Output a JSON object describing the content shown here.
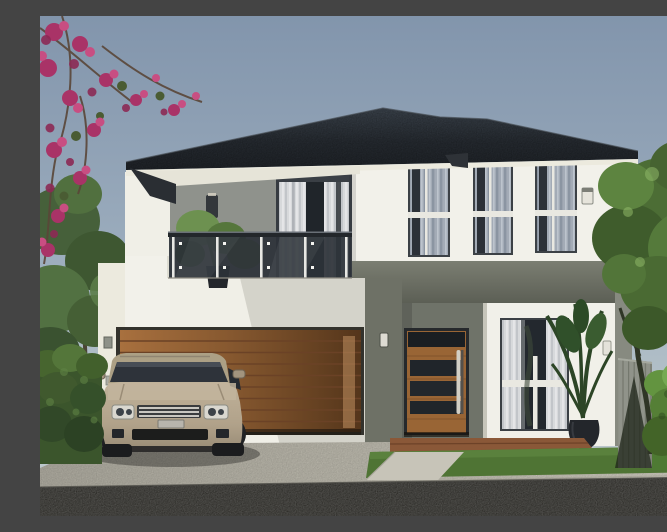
{
  "meta": {
    "title": "3D architectural rendering of a modern two-storey house with timber garage door, glass balcony and champagne SUV parked on the driveway",
    "domain": "natural-image",
    "visible_text": []
  },
  "palette": {
    "sky_top": "#8295ac",
    "sky_horizon": "#c2ccd0",
    "roof_dark": "#23272c",
    "roof_ridge_highlight": "#454c55",
    "soffit_white": "#eceade",
    "wall_white": "#f2f1ea",
    "wall_grey_accent": "#75786d",
    "wall_grey_recess": "#9a9e97",
    "band_grey": "#6a6d62",
    "timber_garage": "#a8703e",
    "timber_door": "#996535",
    "glass_dark": "#2c3238",
    "curtain_white": "#d7d9db",
    "curtain_grey": "#a3abb6",
    "balcony_glass": "#2c3238",
    "hedge_dark_green": "#3b552c",
    "hedge_bright_green": "#5d8f3c",
    "tree_green": "#4c6d35",
    "bougainvillea_magenta": "#b13a6e",
    "driveway_concrete": "#bab7ab",
    "road_asphalt": "#2d2c28",
    "lawn_green": "#4f7434",
    "car_body_champagne": "#b5a78f",
    "porch_brick": "#8a5838",
    "fence_grey": "#90938a"
  },
  "scene": {
    "type": "computer-generated exterior render, front elevation, daytime",
    "sky": {
      "condition": "clear, hazy gradient",
      "top": "#8295ac",
      "horizon": "#c2ccd0"
    },
    "house": {
      "storeys": 2,
      "roof": {
        "style": "double hip roof",
        "colour": "near-black charcoal shingle",
        "eaves": "white soffit with dark fascia"
      },
      "upper_floor": {
        "left_wing": {
          "balcony": {
            "railing": "frameless tinted-glass with slim posts",
            "parapet": "white render",
            "potted_plant": "small green shrub in dark pot"
          },
          "sliding_door": {
            "frame": "dark grey aluminium",
            "curtains": "sheer white, partly open"
          },
          "recess_wall": "light grey render",
          "wall_light": "dark cylindrical up/down sconce"
        },
        "right_wing": {
          "windows": {
            "count": 3,
            "style": "tall double-hung, white mid rail",
            "curtains": "grey sheers"
          },
          "wall": "white render",
          "wall_light": "small white sconce on right pier"
        }
      },
      "ground_floor": {
        "garage_door": {
          "material": "horizontal timber slats",
          "finish": "warm brown, shadowed at right"
        },
        "middle_wall": "dark grey-green render with small white sconce",
        "entry": {
          "door": {
            "material": "timber",
            "glazing": "3 dark horizontal glass slats + transom",
            "handle": "full-height vertical stainless bar"
          },
          "recess_wall": "grey-green render",
          "porch_step": "brick-brown tiled step"
        },
        "window_right": {
          "curtains": "white sheers both sides",
          "mullions": "white cross rails"
        },
        "planter": "tall dark vase with palm-like plant",
        "keypads_left_wall": 2
      }
    },
    "vehicle": {
      "type": "luxury SUV, Range-Rover style",
      "colour": "champagne beige",
      "view": "front three-quarter, parked on driveway facing street",
      "details": [
        "dark windscreen",
        "silver slatted grille",
        "twin round headlamp clusters",
        "black lower intake",
        "roof rails",
        "side mirrors"
      ]
    },
    "landscape": {
      "left": [
        "magenta bougainvillea branches over sky",
        "soft green trees",
        "dark clipped hedge"
      ],
      "right": [
        "large leafy tree",
        "grey vertical-board fence",
        "bright sunlit hedge"
      ],
      "foreground": [
        "broad concrete driveway",
        "light entry path",
        "mown lawn strips",
        "dark asphalt road across bottom"
      ]
    }
  }
}
